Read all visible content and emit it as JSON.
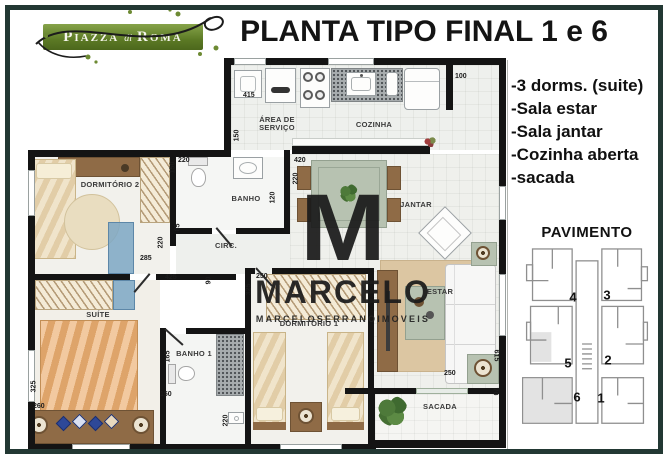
{
  "logo": {
    "word1": "Piazza",
    "word2": "di",
    "word3": "Roma"
  },
  "title": "PLANTA TIPO FINAL 1 e 6",
  "features": {
    "items": [
      "-3 dorms. (suite)",
      "-Sala estar",
      "-Sala jantar",
      "-Cozinha aberta",
      "-sacada"
    ]
  },
  "pavimento": {
    "label": "PAVIMENTO",
    "units": [
      {
        "n": "4",
        "x": 55,
        "y": 49
      },
      {
        "n": "3",
        "x": 89,
        "y": 47
      },
      {
        "n": "5",
        "x": 50,
        "y": 115
      },
      {
        "n": "2",
        "x": 90,
        "y": 112
      },
      {
        "n": "6",
        "x": 59,
        "y": 149
      },
      {
        "n": "1",
        "x": 83,
        "y": 150
      }
    ]
  },
  "plan": {
    "rooms": {
      "servico1": "ÁREA DE",
      "servico2": "SERVIÇO",
      "cozinha": "COZINHA",
      "dormitorio2": "DORMITÓRIO 2",
      "banho": "BANHO",
      "circ": "CIRC.",
      "jantar": "JANTAR",
      "estar": "ESTAR",
      "sacada": "SACADA",
      "suite": "SUÍTE",
      "banho1": "BANHO 1",
      "dormitorio1": "DORMITÓRIO 1"
    },
    "dimensions": [
      {
        "t": "415",
        "x": 215,
        "y": 34,
        "v": 0
      },
      {
        "t": "100",
        "x": 427,
        "y": 15,
        "v": 0
      },
      {
        "t": "150",
        "x": 203,
        "y": 74,
        "v": 1
      },
      {
        "t": "220",
        "x": 150,
        "y": 99,
        "v": 0
      },
      {
        "t": "150",
        "x": 139,
        "y": 106,
        "v": 1
      },
      {
        "t": "420",
        "x": 266,
        "y": 99,
        "v": 0
      },
      {
        "t": "220",
        "x": 262,
        "y": 117,
        "v": 1
      },
      {
        "t": "120",
        "x": 239,
        "y": 136,
        "v": 1
      },
      {
        "t": "85",
        "x": 146,
        "y": 166,
        "v": 1
      },
      {
        "t": "220",
        "x": 127,
        "y": 181,
        "v": 1
      },
      {
        "t": "285",
        "x": 112,
        "y": 197,
        "v": 0
      },
      {
        "t": "425",
        "x": 137,
        "y": 216,
        "v": 0
      },
      {
        "t": "90",
        "x": 177,
        "y": 219,
        "v": 1
      },
      {
        "t": "250",
        "x": 228,
        "y": 215,
        "v": 0
      },
      {
        "t": "325",
        "x": 215,
        "y": 228,
        "v": 1
      },
      {
        "t": "325",
        "x": 0,
        "y": 325,
        "v": 1
      },
      {
        "t": "260",
        "x": 5,
        "y": 345,
        "v": 0
      },
      {
        "t": "165",
        "x": 134,
        "y": 295,
        "v": 1
      },
      {
        "t": "150",
        "x": 132,
        "y": 333,
        "v": 0
      },
      {
        "t": "220",
        "x": 192,
        "y": 359,
        "v": 1
      },
      {
        "t": "250",
        "x": 416,
        "y": 312,
        "v": 0
      },
      {
        "t": "615",
        "x": 462,
        "y": 294,
        "v": 2
      },
      {
        "t": "70",
        "x": 463,
        "y": 330,
        "v": 2
      }
    ]
  },
  "watermark": {
    "initial": "M",
    "name": "MARCELO",
    "subtitle": "MARCELOSERRANOIMOVEIS"
  },
  "colors": {
    "frame": "#223833",
    "logo_green": "#6d8a33",
    "wall": "#141414",
    "wood": "#8f6b46",
    "counter_gray": "#a7acae",
    "bed_tan": "#ecb277",
    "bed_cream": "#ead9b4",
    "accent_blue": "#7da7c4",
    "rug": "#dcc6a2",
    "table_green": "#b7c2b1",
    "watermark": "#1b1b1b"
  }
}
